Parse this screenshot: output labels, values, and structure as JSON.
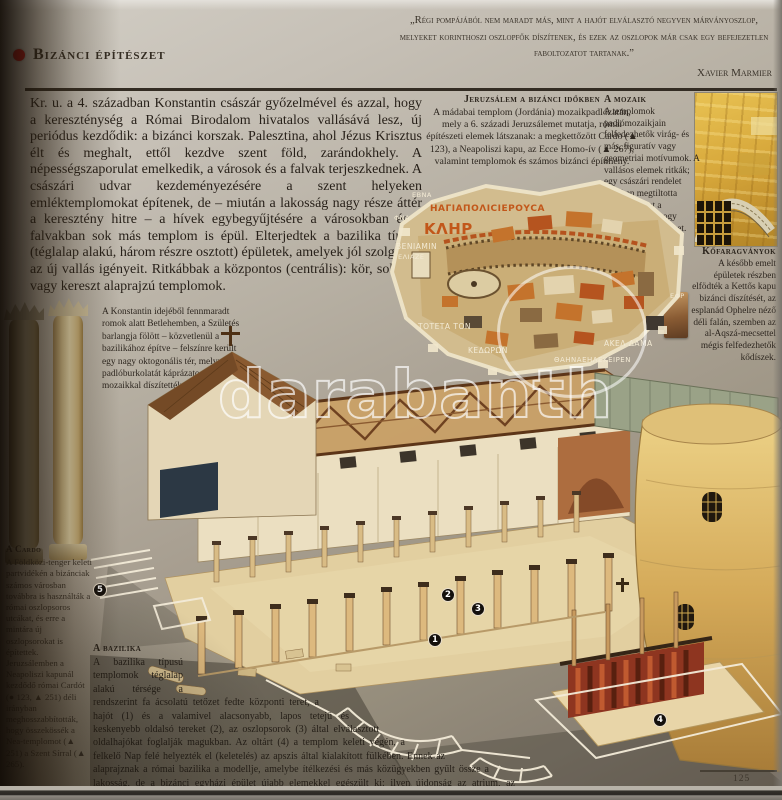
{
  "header": {
    "title": "Bizánci építészet"
  },
  "quote": {
    "text": "„Régi pompájából nem maradt más, mint a hajót elválasztó negyven márványoszlop, melyeket korinthoszi oszlopfők díszítenek, és ezek az oszlopok már csak egy befejezetlen faboltozatot tartanak.”",
    "attribution": "Xavier Marmier"
  },
  "intro": "Kr. u. a 4. században Konstantin császár győzelmével és azzal, hogy a kereszténység a Római Birodalom hivatalos vallásává lesz, új periódus kezdődik: a bizánci korszak. Palesztina, ahol Jézus Krisztus élt és meghalt, ettől kezdve szent föld, zarándokhely. A népességszaporulat emelkedik, a városok és a falvak terjeszkednek. A császári udvar kezdeményezésére a szent helyeken emléktemplomokat építenek, de – miután a lakosság nagy része áttér a keresztény hitre – a hívek egybegyűjtésére a városokban és a falvakban sok más templom is épül. Elterjedtek a bazilika típusú (téglalap alakú, három részre osztott) épületek, amelyek jól szolgálják az új vallás igényeit. Ritkábbak a központos (centrális): kör, sokszög vagy kereszt alaprajzú templomok.",
  "sections": {
    "jerusalem": {
      "title": "Jeruzsálem a bizánci időkben",
      "body": "A mádabai templom (Jordánia) mozaikpadlózatán, mely a 6. századi Jeruzsálemet mutatja, római építészeti elemek látszanak: a megkettőzött Cardo (▲ 123), a Neapoliszi kapu, az Ecce Homo-ív (▲ 267), valamint templomok és számos bizánci építmény."
    },
    "mosaic_note": {
      "title": "A mozaik",
      "body": "A templomok padlómozaikjain felfedezhetők virág- és más, figuratív vagy geometriai motívumok. A vallásos elemek ritkák; egy császári rendelet 427-ben megtiltotta ábrázolásukat a padlózaton, nehogy lábbal tiporják ezeket."
    },
    "stone_carvings": {
      "title": "Kőfaragványok",
      "body": "A később emelt épületek részben elfödték a Kettős kapu bizánci díszítését, az esplanád Ophelre néző déli falán, szemben az al-Aqszá-mecsettel mégis felfedezhetők kődíszek."
    },
    "constantine": "A Konstantin idejéből fennmaradt romok alatt Betlehemben, a Születés barlangja fölött – közvetlenül a bazilikához építve – felszínre került egy nagy oktogonális tér, melynek padlóburkolatát káprázatos mozaikkal díszítették.",
    "cardo": {
      "title": "A Cardo",
      "body": "A Földközi-tenger keleti partvidékén a bizánciak számos városban továbbra is használták a római oszlopsoros utcákat, és erre a mintára új oszlopsorokat is építettek. Jeruzsálemben a Neapoliszi kapunál kezdődő római Cardót (● 123, ▲ 251) déli irányban meghosszabbították, hogy összekössék a Nea-templomot (▲ 251) a Szent Sírral (▲ 265)."
    },
    "basilica": {
      "title": "A bazilika",
      "body": "A bazilika típusú templomok téglalap alakú térsége a rendszerint fa ácsolatú tetőzet fedte központi teret, a hajót (1) és a valamivel alacsonyabb, lapos tetejű és keskenyebb oldalsó tereket (2), az oszlopsorok (3) által elválasztott oldalhajókat foglalják magukban. Az oltárt (4) a templom keleti végén, a felkelő Nap felé helyezték el (keletelés) az apszis által kialakított fülkében. Ennek az alaprajznak a római bazilika a modellje, amelybe ítélkezési és más közügyekben gyűlt össze a lakosság, de a bizánci egyházi épület újabb elemekkel egészült ki: ilyen újdonság az atrium, az oszlopsorral övezett udvar és a narthex (5), a főhajó bejárata előtti széles folyosó."
    }
  },
  "mosaic": {
    "labels": [
      "ΕΒΝΑ",
      "ΗΑΓΙΑΠΟΛΙCΙΕΡΟΥCΑ",
      "ΚΛΗΡ",
      "ΦΝΑ",
      "ΒΕΝΙΑΜΙΝ",
      "ΕΛΙΑΖΕ",
      "ΤΟΤΕΤΑ ΤΟΝ",
      "ΚΕΔΩΡΩΝ",
      "ΑΚΕΛ ΔΑΜΑ",
      "ΘΑΗΝΑΕΗΛΕΚΕΙΡΕΝ",
      "ΕΦΡ"
    ]
  },
  "diagram": {
    "markers": [
      "1",
      "2",
      "3",
      "4",
      "5"
    ]
  },
  "watermark": {
    "text": "darabanth"
  },
  "page_number": "125",
  "colors": {
    "accent_red": "#cf1313",
    "page_gray": "#a89f91",
    "illustration_gold": "#d8a93c"
  }
}
